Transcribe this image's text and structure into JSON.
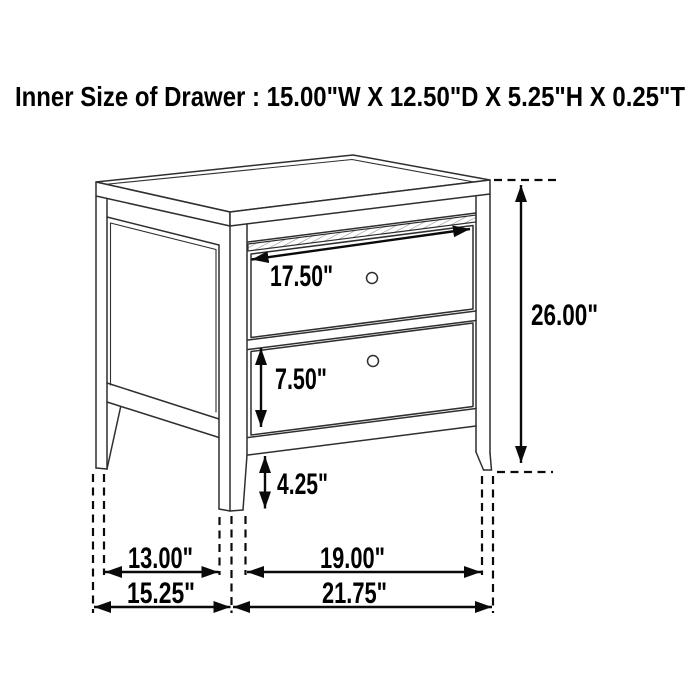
{
  "header": {
    "title": "Inner Size of Drawer : 15.00\"W X 12.50\"D X 5.25\"H X 0.25\"T"
  },
  "diagram": {
    "subject": "two-drawer nightstand line drawing",
    "drawer_count": 2
  },
  "dimensions": {
    "drawer_width": "17.50\"",
    "overall_height": "26.00\"",
    "bottom_drawer_height": "7.50\"",
    "leg_height": "4.25\"",
    "side_leg_span": "13.00\"",
    "front_leg_span": "19.00\"",
    "overall_depth": "15.25\"",
    "overall_width": "21.75\""
  },
  "colors": {
    "background": "#ffffff",
    "line_art": "#2f2f2f",
    "dimension_ink": "#0a0a0a",
    "text": "#000000"
  }
}
